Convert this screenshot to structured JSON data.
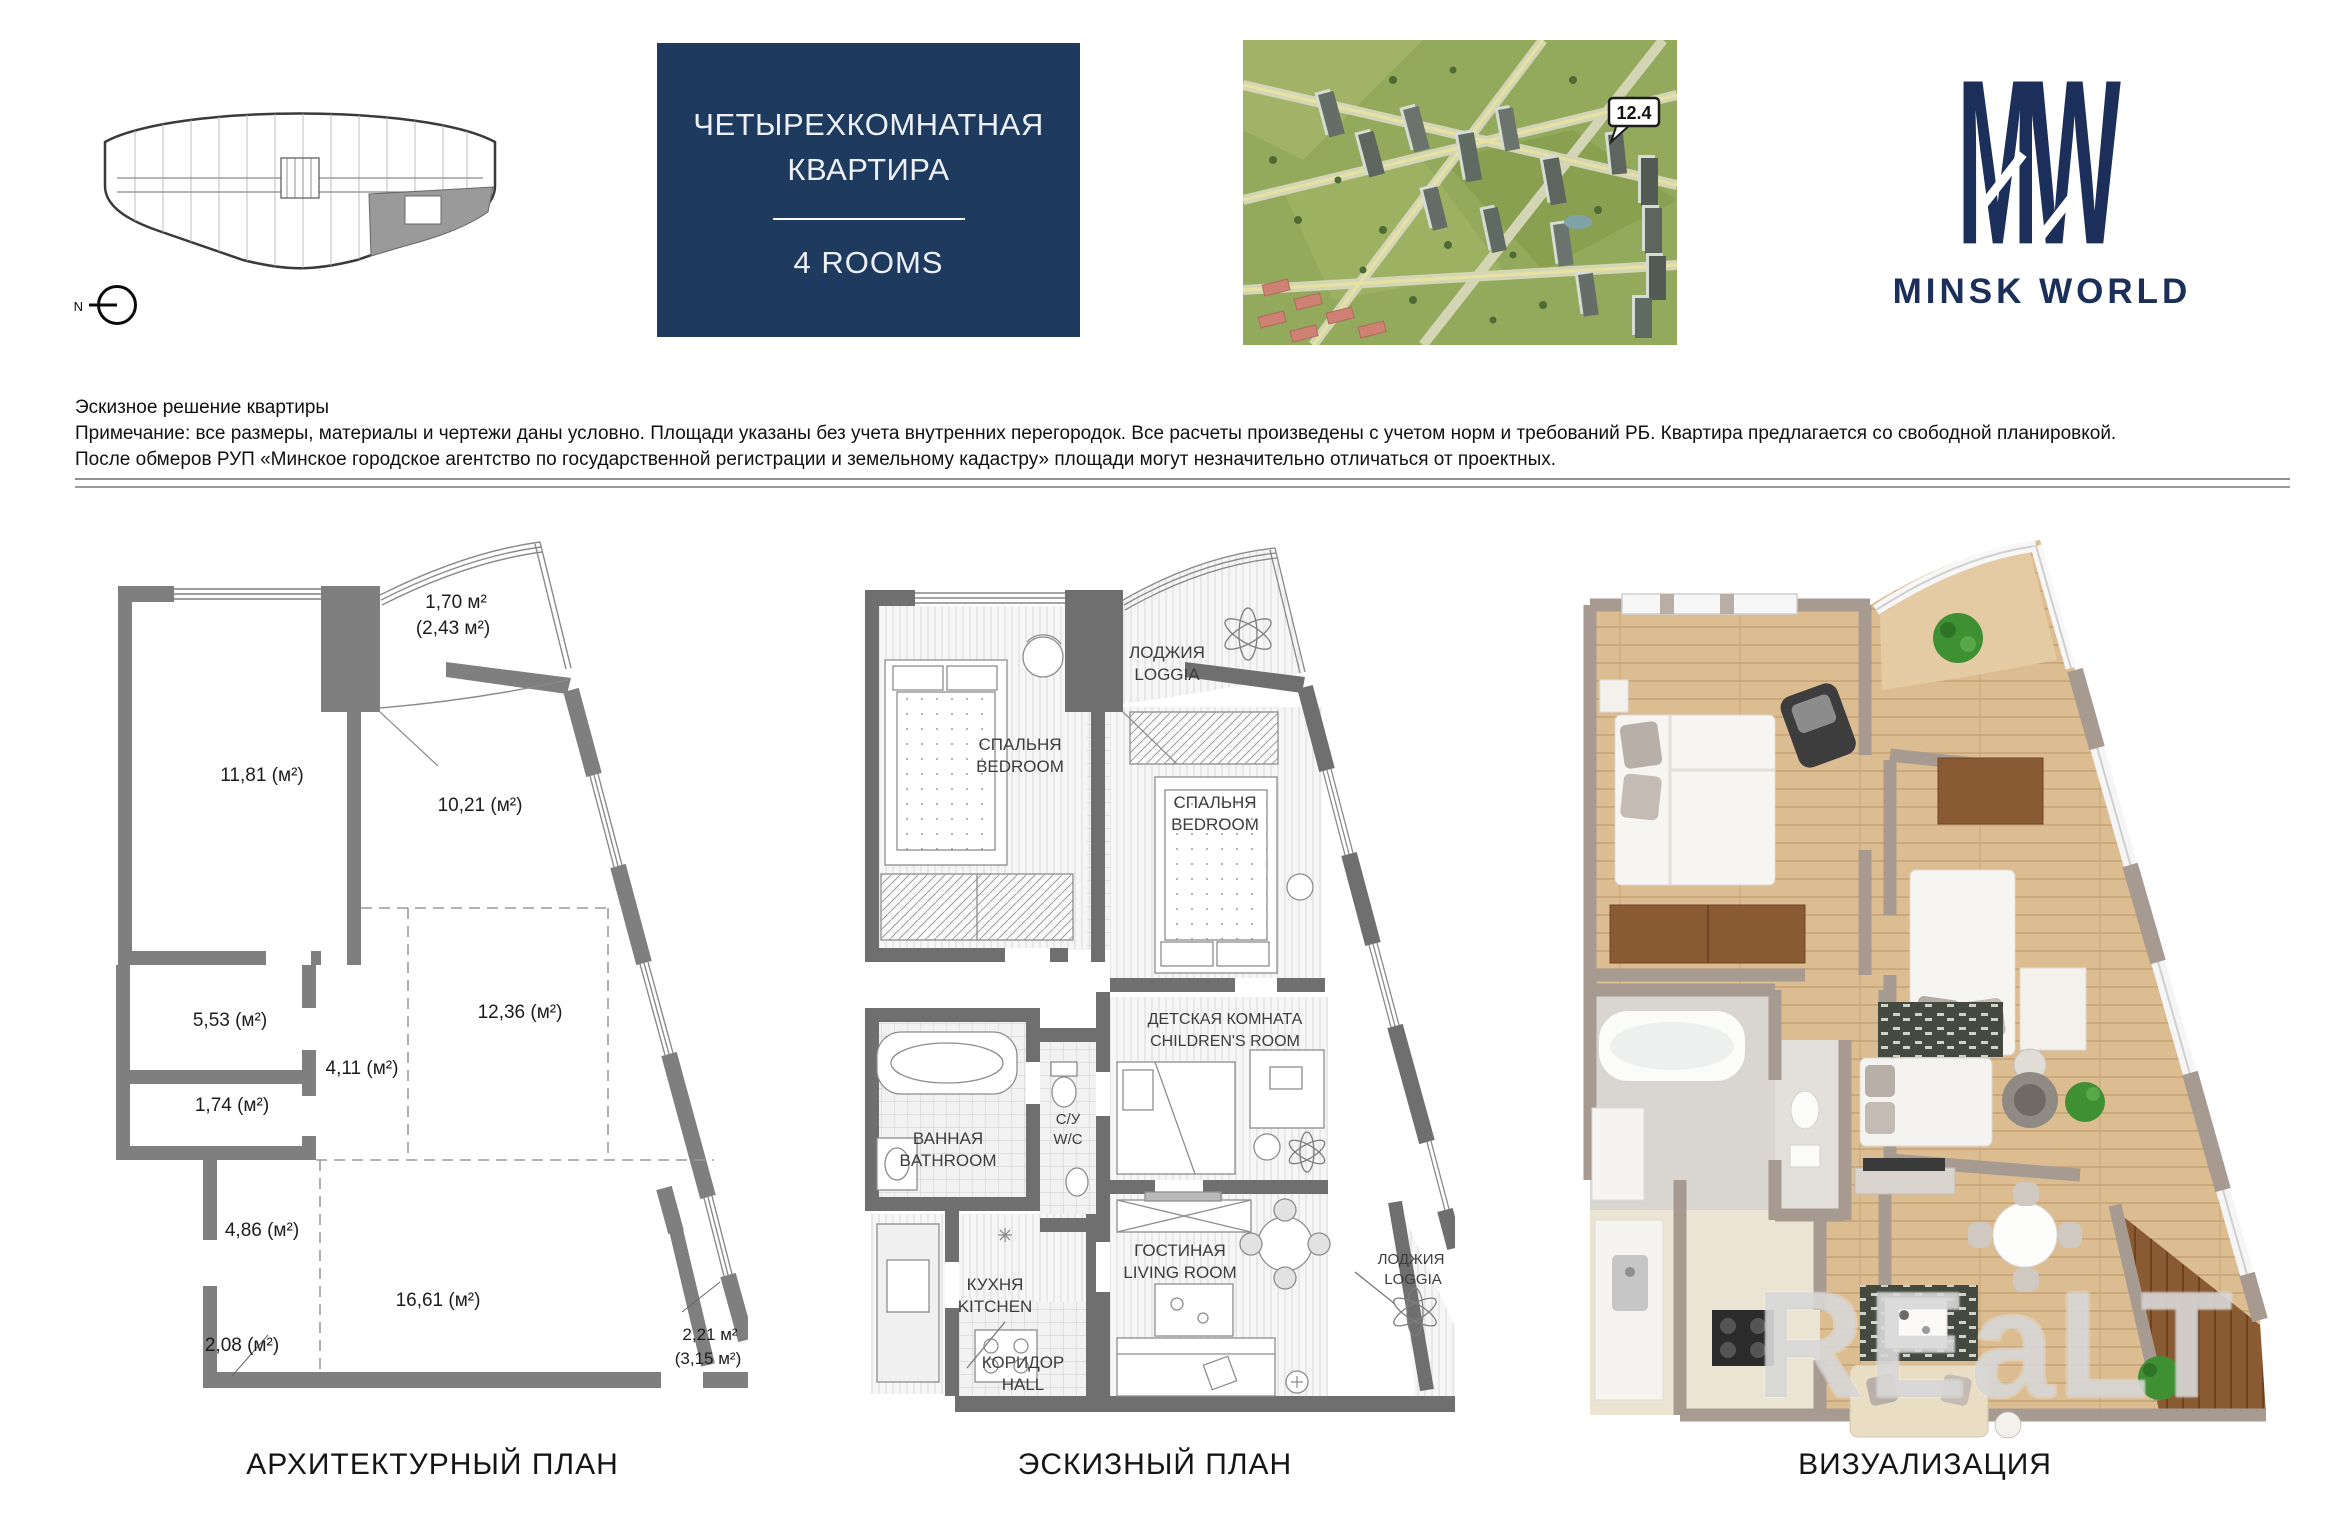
{
  "header": {
    "key_plan": {
      "north_label": "N"
    },
    "title_block": {
      "line1": "ЧЕТЫРЕХКОМНАТНАЯ",
      "line2": "КВАРТИРА",
      "subtitle": "4 ROOMS",
      "bg_color": "#1e3a5e"
    },
    "aerial": {
      "building_label": "12.4"
    },
    "logo": {
      "monogram": "MW",
      "brand": "MINSK WORLD",
      "color": "#1b2f5a"
    }
  },
  "disclaimer": {
    "line1": "Эскизное решение квартиры",
    "line2": "Примечание: все размеры, материалы и чертежи даны условно. Площади указаны без учета внутренних перегородок. Все расчеты произведены с учетом норм и требований РБ. Квартира предлагается со свободной планировкой.",
    "line3": "После обмеров РУП «Минское городское агентство по государственной регистрации и земельному кадастру» площади могут незначительно отличаться от проектных."
  },
  "plans": {
    "architectural": {
      "caption": "АРХИТЕКТУРНЫЙ ПЛАН",
      "areas": {
        "loggia_top": "1,70 м²",
        "loggia_top_total": "(2,43 м²)",
        "a1181": "11,81 (м²)",
        "a1021": "10,21 (м²)",
        "a553": "5,53 (м²)",
        "a411": "4,11 (м²)",
        "a174": "1,74 (м²)",
        "a1236": "12,36 (м²)",
        "a486": "4,86 (м²)",
        "a1661": "16,61 (м²)",
        "a208": "2,08 (м²)",
        "loggia_bottom": "2,21 м²",
        "loggia_bottom_total": "(3,15 м²)"
      }
    },
    "sketch": {
      "caption": "ЭСКИЗНЫЙ ПЛАН",
      "rooms": {
        "bedroom1_ru": "СПАЛЬНЯ",
        "bedroom1_en": "BEDROOM",
        "loggia_top_ru": "ЛОДЖИЯ",
        "loggia_top_en": "LOGGIA",
        "bedroom2_ru": "СПАЛЬНЯ",
        "bedroom2_en": "BEDROOM",
        "bathroom_ru": "ВАННАЯ",
        "bathroom_en": "BATHROOM",
        "wc_ru": "С/У",
        "wc_en": "W/C",
        "children_ru": "ДЕТСКАЯ КОМНАТА",
        "children_en": "CHILDREN'S ROOM",
        "kitchen_ru": "КУХНЯ",
        "kitchen_en": "KITCHEN",
        "living_ru": "ГОСТИНАЯ",
        "living_en": "LIVING ROOM",
        "hall_ru": "КОРИДОР",
        "hall_en": "HALL",
        "loggia_bottom_ru": "ЛОДЖИЯ",
        "loggia_bottom_en": "LOGGIA"
      }
    },
    "visualization": {
      "caption": "ВИЗУАЛИЗАЦИЯ",
      "watermark": "REaLT"
    }
  }
}
